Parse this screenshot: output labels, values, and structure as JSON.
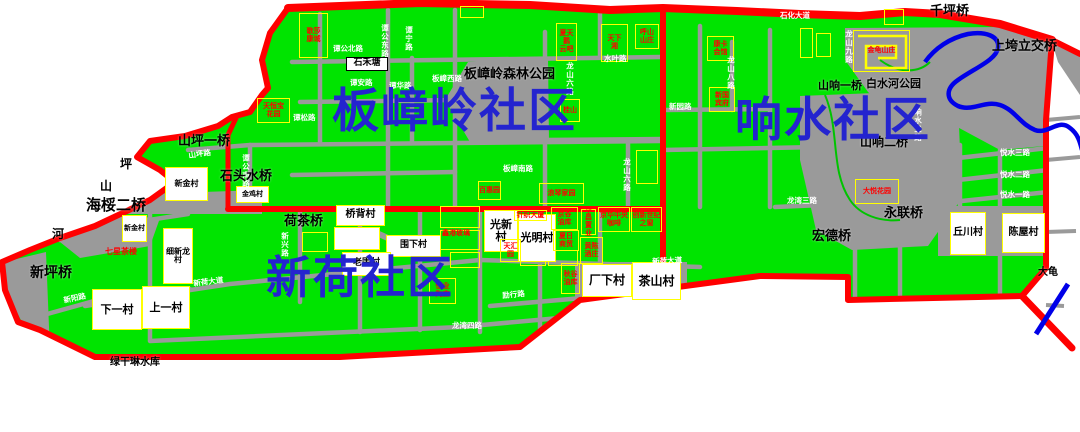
{
  "map": {
    "width": 1080,
    "height": 432,
    "colors": {
      "land": "#00e400",
      "boundary_road": "#ff0000",
      "street": "#9a9a9a",
      "park": "#9a9a9a",
      "river": "#0000e8",
      "village_fill": "#ffffff",
      "parcel_border": "#ffff00",
      "facility_text": "#ff0000",
      "community_text": "#2424cf"
    },
    "communities": [
      {
        "name": "板嶂岭社区",
        "x": 332,
        "y": 88,
        "fs": 47
      },
      {
        "name": "响水社区",
        "x": 735,
        "y": 97,
        "fs": 47
      },
      {
        "name": "新荷社区",
        "x": 266,
        "y": 255,
        "fs": 45
      }
    ],
    "black_labels": [
      {
        "text": "板嶂岭森林公园",
        "x": 464,
        "y": 68,
        "fs": 13
      },
      {
        "text": "山坪一桥",
        "x": 178,
        "y": 135,
        "fs": 13
      },
      {
        "text": "石头水桥",
        "x": 220,
        "y": 170,
        "fs": 13
      },
      {
        "text": "海桵二桥",
        "x": 86,
        "y": 198,
        "fs": 15
      },
      {
        "text": "新坪桥",
        "x": 30,
        "y": 266,
        "fs": 14
      },
      {
        "text": "荷茶桥",
        "x": 284,
        "y": 215,
        "fs": 13
      },
      {
        "text": "河",
        "x": 52,
        "y": 228,
        "fs": 12
      },
      {
        "text": "坪",
        "x": 120,
        "y": 158,
        "fs": 12
      },
      {
        "text": "山",
        "x": 100,
        "y": 180,
        "fs": 12
      },
      {
        "text": "千坪桥",
        "x": 930,
        "y": 5,
        "fs": 13
      },
      {
        "text": "上垮立交桥",
        "x": 992,
        "y": 40,
        "fs": 13
      },
      {
        "text": "山响一桥",
        "x": 818,
        "y": 80,
        "fs": 11
      },
      {
        "text": "白水河公园",
        "x": 866,
        "y": 78,
        "fs": 11
      },
      {
        "text": "山响二桥",
        "x": 860,
        "y": 136,
        "fs": 12
      },
      {
        "text": "永联桥",
        "x": 884,
        "y": 207,
        "fs": 13
      },
      {
        "text": "宏德桥",
        "x": 812,
        "y": 230,
        "fs": 13
      },
      {
        "text": "绿干琳水库",
        "x": 110,
        "y": 358,
        "fs": 10
      },
      {
        "text": "大龟",
        "x": 1038,
        "y": 268,
        "fs": 10
      }
    ],
    "villages": [
      {
        "name": "石禾塘",
        "x": 346,
        "y": 57,
        "w": 42,
        "h": 14,
        "fs": 9,
        "bc": "#000000"
      },
      {
        "name": "新金村",
        "x": 165,
        "y": 167,
        "w": 43,
        "h": 34,
        "fs": 8
      },
      {
        "name": "金鸡村",
        "x": 236,
        "y": 186,
        "w": 33,
        "h": 17,
        "fs": 7
      },
      {
        "name": "新金村",
        "x": 122,
        "y": 215,
        "w": 25,
        "h": 27,
        "fs": 7
      },
      {
        "name": "细新龙村",
        "x": 163,
        "y": 228,
        "w": 30,
        "h": 56,
        "fs": 8
      },
      {
        "name": "下一村",
        "x": 92,
        "y": 289,
        "w": 50,
        "h": 41,
        "fs": 11
      },
      {
        "name": "上一村",
        "x": 142,
        "y": 286,
        "w": 48,
        "h": 43,
        "fs": 11
      },
      {
        "name": "桥背村",
        "x": 336,
        "y": 205,
        "w": 49,
        "h": 21,
        "fs": 10
      },
      {
        "name": "",
        "x": 334,
        "y": 227,
        "w": 46,
        "h": 23,
        "fs": 8
      },
      {
        "name": "围下村",
        "x": 386,
        "y": 235,
        "w": 55,
        "h": 22,
        "fs": 9
      },
      {
        "name": "老围村",
        "x": 342,
        "y": 252,
        "w": 49,
        "h": 24,
        "fs": 9
      },
      {
        "name": "光新村",
        "x": 484,
        "y": 210,
        "w": 34,
        "h": 42,
        "fs": 11
      },
      {
        "name": "光明村",
        "x": 518,
        "y": 214,
        "w": 38,
        "h": 48,
        "fs": 11
      },
      {
        "name": "厂下村",
        "x": 582,
        "y": 264,
        "w": 50,
        "h": 33,
        "fs": 12
      },
      {
        "name": "茶山村",
        "x": 632,
        "y": 262,
        "w": 49,
        "h": 38,
        "fs": 12
      },
      {
        "name": "丘川村",
        "x": 950,
        "y": 212,
        "w": 36,
        "h": 43,
        "fs": 10
      },
      {
        "name": "陈屋村",
        "x": 1002,
        "y": 213,
        "w": 43,
        "h": 40,
        "fs": 10
      }
    ],
    "facilities": [
      {
        "text": "歌莎\n康城",
        "x": 299,
        "y": 13,
        "w": 29,
        "h": 45
      },
      {
        "text": "天恒宝\n花园",
        "x": 257,
        "y": 98,
        "w": 33,
        "h": 25
      },
      {
        "text": "天下\n湘",
        "x": 601,
        "y": 24,
        "w": 27,
        "h": 38
      },
      {
        "text": "呼山\n山庄",
        "x": 635,
        "y": 24,
        "w": 24,
        "h": 25
      },
      {
        "text": "夏天鹅\n云吧",
        "x": 556,
        "y": 23,
        "w": 21,
        "h": 38
      },
      {
        "text": "桂山",
        "x": 560,
        "y": 99,
        "w": 20,
        "h": 23
      },
      {
        "text": "康卡\n会馆",
        "x": 707,
        "y": 36,
        "w": 27,
        "h": 25
      },
      {
        "text": "新国\n宾府",
        "x": 709,
        "y": 87,
        "w": 26,
        "h": 25
      },
      {
        "text": "金龟山庄",
        "x": 853,
        "y": 30,
        "w": 57,
        "h": 42,
        "spiral": true
      },
      {
        "text": "百惠园",
        "x": 478,
        "y": 181,
        "w": 23,
        "h": 19
      },
      {
        "text": "浪琴家园",
        "x": 539,
        "y": 183,
        "w": 45,
        "h": 21
      },
      {
        "text": "针织大厦",
        "x": 514,
        "y": 210,
        "w": 33,
        "h": 11
      },
      {
        "text": "京谷\n油库",
        "x": 551,
        "y": 207,
        "w": 27,
        "h": 23
      },
      {
        "text": "夏日\n商贸",
        "x": 553,
        "y": 230,
        "w": 26,
        "h": 21
      },
      {
        "text": "华昌\n置业",
        "x": 581,
        "y": 209,
        "w": 15,
        "h": 26
      },
      {
        "text": "京华中央\n咖啡",
        "x": 598,
        "y": 207,
        "w": 32,
        "h": 25
      },
      {
        "text": "创新世纪\n之窗",
        "x": 631,
        "y": 207,
        "w": 31,
        "h": 25
      },
      {
        "text": "天汇\n园",
        "x": 500,
        "y": 239,
        "w": 21,
        "h": 23
      },
      {
        "text": "黄陈\n酒庄",
        "x": 580,
        "y": 237,
        "w": 23,
        "h": 27
      },
      {
        "text": "秋谷\n油库",
        "x": 561,
        "y": 263,
        "w": 19,
        "h": 31
      },
      {
        "text": "恒业\n陶庄",
        "x": 429,
        "y": 278,
        "w": 27,
        "h": 26
      },
      {
        "text": "大悦花园",
        "x": 855,
        "y": 179,
        "w": 44,
        "h": 25
      }
    ],
    "red_texts": [
      {
        "text": "七星茶楼",
        "x": 105,
        "y": 248,
        "fs": 8
      },
      {
        "text": "鑫港玻璃",
        "x": 442,
        "y": 230,
        "fs": 7
      }
    ],
    "road_labels": [
      {
        "text": "石化大道",
        "x": 780,
        "y": 12
      },
      {
        "text": "谭公北路",
        "x": 333,
        "y": 45
      },
      {
        "text": "谭公东路",
        "x": 381,
        "y": 24,
        "v": true
      },
      {
        "text": "谭宁路",
        "x": 405,
        "y": 26,
        "v": true
      },
      {
        "text": "谭安路",
        "x": 350,
        "y": 79
      },
      {
        "text": "谭松路",
        "x": 293,
        "y": 114
      },
      {
        "text": "谭华路",
        "x": 389,
        "y": 82
      },
      {
        "text": "板嶂西路",
        "x": 432,
        "y": 75
      },
      {
        "text": "板嶂南路",
        "x": 503,
        "y": 165
      },
      {
        "text": "龙山六路",
        "x": 566,
        "y": 62,
        "v": true
      },
      {
        "text": "龙山六路",
        "x": 623,
        "y": 158,
        "v": true
      },
      {
        "text": "龙山八路",
        "x": 727,
        "y": 56,
        "v": true
      },
      {
        "text": "龙山九路",
        "x": 845,
        "y": 30,
        "v": true
      },
      {
        "text": "新园路",
        "x": 669,
        "y": 103
      },
      {
        "text": "水叶路",
        "x": 604,
        "y": 55
      },
      {
        "text": "响水三路",
        "x": 914,
        "y": 108,
        "v": true
      },
      {
        "text": "悦水三路",
        "x": 1000,
        "y": 149
      },
      {
        "text": "悦水二路",
        "x": 1000,
        "y": 171
      },
      {
        "text": "悦水一路",
        "x": 1000,
        "y": 191
      },
      {
        "text": "龙湾三路",
        "x": 787,
        "y": 197
      },
      {
        "text": "龙湾四路",
        "x": 452,
        "y": 322
      },
      {
        "text": "新荷大道",
        "x": 193,
        "y": 280,
        "rot": -7
      },
      {
        "text": "新荷大道",
        "x": 652,
        "y": 258,
        "rot": -3
      },
      {
        "text": "新阳路",
        "x": 63,
        "y": 297,
        "rot": -12
      },
      {
        "text": "新兴路",
        "x": 281,
        "y": 232,
        "v": true
      },
      {
        "text": "励行路",
        "x": 502,
        "y": 292,
        "rot": -5
      },
      {
        "text": "山坪路",
        "x": 188,
        "y": 152,
        "rot": -8
      },
      {
        "text": "谭公南路",
        "x": 242,
        "y": 154,
        "v": true
      }
    ],
    "parcels": [
      {
        "x": 460,
        "y": 6,
        "w": 24,
        "h": 12
      },
      {
        "x": 800,
        "y": 28,
        "w": 13,
        "h": 30
      },
      {
        "x": 816,
        "y": 33,
        "w": 15,
        "h": 24
      },
      {
        "x": 884,
        "y": 9,
        "w": 20,
        "h": 16
      },
      {
        "x": 440,
        "y": 206,
        "w": 40,
        "h": 22
      },
      {
        "x": 440,
        "y": 230,
        "w": 40,
        "h": 20
      },
      {
        "x": 636,
        "y": 150,
        "w": 22,
        "h": 34
      },
      {
        "x": 450,
        "y": 252,
        "w": 30,
        "h": 16
      },
      {
        "x": 520,
        "y": 250,
        "w": 26,
        "h": 16
      },
      {
        "x": 548,
        "y": 250,
        "w": 30,
        "h": 16
      },
      {
        "x": 302,
        "y": 232,
        "w": 26,
        "h": 20
      }
    ]
  }
}
